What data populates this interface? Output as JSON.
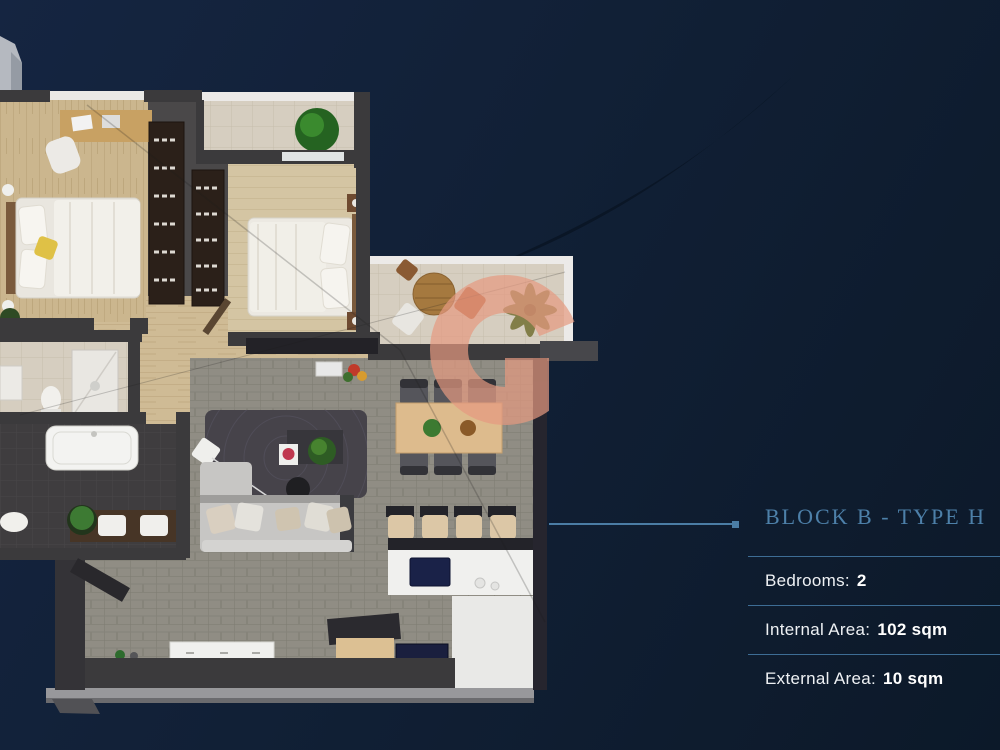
{
  "panel": {
    "title": "BLOCK B - TYPE H",
    "specs": [
      {
        "label": "Bedrooms:",
        "value": "2"
      },
      {
        "label": "Internal Area:",
        "value": "102 sqm"
      },
      {
        "label": "External Area:",
        "value": "10 sqm"
      }
    ]
  },
  "floorplan": {
    "watermark_letter": "G",
    "rooms": [
      "bedroom-1",
      "bedroom-2",
      "bathroom",
      "wc",
      "hallway",
      "living-dining-room",
      "kitchen",
      "balcony-top",
      "terrace"
    ]
  },
  "colors": {
    "background_top": "#152541",
    "background_bottom": "#0c1929",
    "swoosh": "#0a1626",
    "accent_line": "#4b7da5",
    "title_text": "#4d80a9",
    "divider": "#3d6d95",
    "body_text": "#ffffff",
    "watermark": "#e69a81",
    "wall": "#3b3a3c",
    "wood_floor": "#cbb68e",
    "tile_floor": "#d6cec0",
    "paver_floor": "#908d84",
    "bath_floor": "#3f3d3f"
  }
}
